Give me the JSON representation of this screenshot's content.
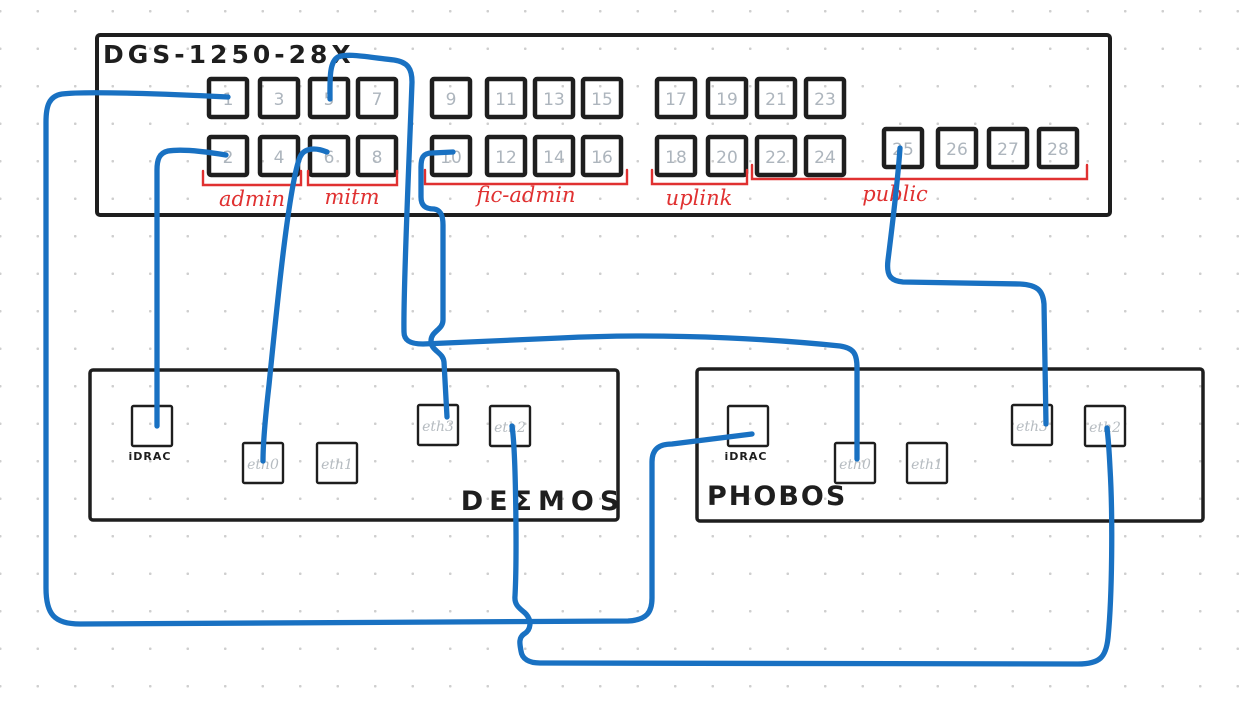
{
  "diagram": {
    "colors": {
      "stroke": "#1e1e1e",
      "cable": "#1971c2",
      "group_red": "#e03131",
      "port_number_gray": "#adb5bd"
    },
    "switch": {
      "title": "DGS-1250-28X",
      "ports": [
        "1",
        "2",
        "3",
        "4",
        "5",
        "6",
        "7",
        "8",
        "9",
        "10",
        "11",
        "12",
        "13",
        "14",
        "15",
        "16",
        "17",
        "18",
        "19",
        "20",
        "21",
        "22",
        "23",
        "24",
        "25",
        "26",
        "27",
        "28"
      ],
      "groups": [
        {
          "label": "admin",
          "ports": "1-4"
        },
        {
          "label": "mitm",
          "ports": "5-8"
        },
        {
          "label": "fic-admin",
          "ports": "9-16"
        },
        {
          "label": "uplink",
          "ports": "17-20"
        },
        {
          "label": "public",
          "ports": "21-28"
        }
      ]
    },
    "servers": [
      {
        "name": "DEΣMOS",
        "ports": [
          "iDRAC",
          "eth0",
          "eth1",
          "eth3",
          "eth2"
        ]
      },
      {
        "name": "PHOBOS",
        "ports": [
          "iDRAC",
          "eth0",
          "eth1",
          "eth3",
          "eth2"
        ]
      }
    ],
    "connections": [
      {
        "from": "switch port 1",
        "to": "PHOBOS iDRAC"
      },
      {
        "from": "switch port 2",
        "to": "DEΣMOS iDRAC"
      },
      {
        "from": "switch port 5",
        "to": "PHOBOS eth0"
      },
      {
        "from": "switch port 6",
        "to": "DEΣMOS eth0"
      },
      {
        "from": "switch port 10",
        "to": "DEΣMOS eth3"
      },
      {
        "from": "switch port 25",
        "to": "PHOBOS eth3"
      },
      {
        "from": "DEΣMOS eth2",
        "to": "PHOBOS eth2"
      }
    ]
  }
}
